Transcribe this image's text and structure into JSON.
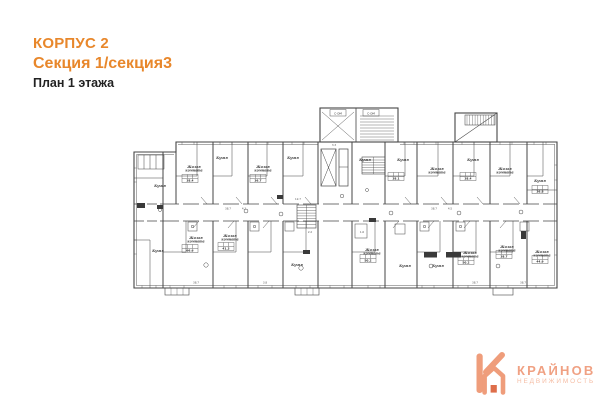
{
  "header": {
    "line1": "КОРПУС 2",
    "line2": "Секция 1/секция3",
    "line3": "План 1 этажа",
    "accent_color": "#E8872B",
    "text_color": "#222222"
  },
  "plan": {
    "stroke_color": "#454545",
    "tags": [
      {
        "x": 338,
        "y": 113,
        "label": "С-ОМ"
      },
      {
        "x": 371,
        "y": 113,
        "label": "С-ОМ"
      }
    ],
    "rooms": [
      {
        "x": 160,
        "y": 187,
        "label": "Кухня"
      },
      {
        "x": 194,
        "y": 168,
        "label": "Жилая комната"
      },
      {
        "x": 222,
        "y": 159,
        "label": "Кухня"
      },
      {
        "x": 263,
        "y": 168,
        "label": "Жилая комната"
      },
      {
        "x": 293,
        "y": 159,
        "label": "Кухня"
      },
      {
        "x": 365,
        "y": 161,
        "label": "Кухня"
      },
      {
        "x": 403,
        "y": 161,
        "label": "Кухня"
      },
      {
        "x": 437,
        "y": 170,
        "label": "Жилая комната"
      },
      {
        "x": 473,
        "y": 161,
        "label": "Кухня"
      },
      {
        "x": 505,
        "y": 170,
        "label": "Жилая комната"
      },
      {
        "x": 540,
        "y": 182,
        "label": "Кухня"
      },
      {
        "x": 158,
        "y": 252,
        "label": "Кухня"
      },
      {
        "x": 196,
        "y": 239,
        "label": "Жилая комната"
      },
      {
        "x": 230,
        "y": 237,
        "label": "Жилая комната"
      },
      {
        "x": 297,
        "y": 266,
        "label": "Кухня"
      },
      {
        "x": 372,
        "y": 251,
        "label": "Жилая комната"
      },
      {
        "x": 405,
        "y": 267,
        "label": "Кухня"
      },
      {
        "x": 438,
        "y": 267,
        "label": "Кухня"
      },
      {
        "x": 470,
        "y": 254,
        "label": "Жилая комната"
      },
      {
        "x": 507,
        "y": 248,
        "label": "Жилая комната"
      },
      {
        "x": 542,
        "y": 253,
        "label": "Жилая комната"
      }
    ],
    "area_tables": [
      {
        "x": 190,
        "y": 181,
        "value": "38.4"
      },
      {
        "x": 258,
        "y": 181,
        "value": "36.7"
      },
      {
        "x": 396,
        "y": 179,
        "value": "38.1"
      },
      {
        "x": 468,
        "y": 179,
        "value": "38.4"
      },
      {
        "x": 540,
        "y": 192,
        "value": "36.8"
      },
      {
        "x": 190,
        "y": 251,
        "value": "66.6"
      },
      {
        "x": 226,
        "y": 249,
        "value": "41.3"
      },
      {
        "x": 368,
        "y": 261,
        "value": "50.2"
      },
      {
        "x": 466,
        "y": 263,
        "value": "50.2"
      },
      {
        "x": 504,
        "y": 257,
        "value": "38.7"
      },
      {
        "x": 540,
        "y": 262,
        "value": "44.9"
      }
    ],
    "dims": [
      {
        "x": 228,
        "y": 209.5,
        "t": "38.7"
      },
      {
        "x": 244,
        "y": 209.5,
        "t": "4.3"
      },
      {
        "x": 298,
        "y": 200,
        "t": "12.7"
      },
      {
        "x": 334,
        "y": 146,
        "t": "3.3"
      },
      {
        "x": 434,
        "y": 209.5,
        "t": "38.7"
      },
      {
        "x": 450,
        "y": 209.5,
        "t": "4.5"
      },
      {
        "x": 362,
        "y": 233,
        "t": "1.6"
      },
      {
        "x": 310,
        "y": 233,
        "t": "2.2"
      },
      {
        "x": 196,
        "y": 283.5,
        "t": "38.7"
      },
      {
        "x": 265,
        "y": 283.5,
        "t": "3.8"
      },
      {
        "x": 475,
        "y": 283.5,
        "t": "38.7"
      },
      {
        "x": 523,
        "y": 283.5,
        "t": "38.7"
      }
    ]
  },
  "logo": {
    "name": "КРАЙНОВ",
    "subtitle": "НЕДВИЖИМОСТЬ",
    "name_color": "#F0A183",
    "subtitle_color": "#F5BDA4",
    "icon_color": "#EF9D7B",
    "icon_door_color": "#DE6E4A",
    "icon": "k-house-icon"
  }
}
